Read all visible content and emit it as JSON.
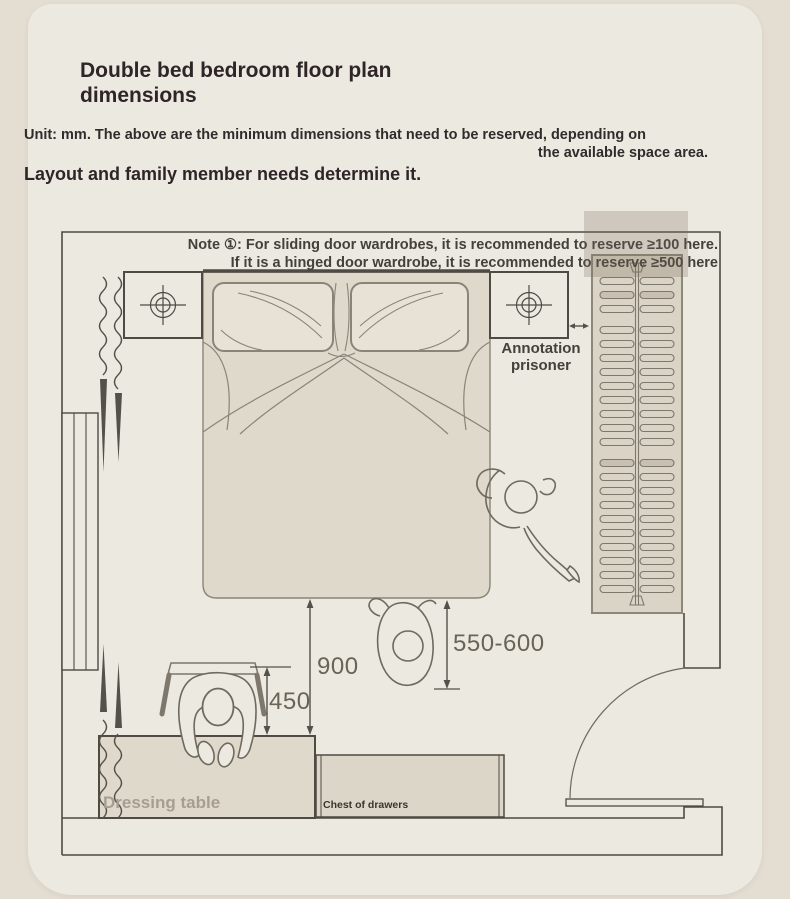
{
  "header": {
    "title": "Double bed bedroom floor plan dimensions",
    "unit_note_line1": "Unit: mm. The above are the minimum dimensions that need to be reserved, depending on",
    "unit_note_line2": "the available space area.",
    "layout_note": "Layout and family member needs determine it."
  },
  "plan": {
    "note": {
      "line1": "Note ①: For sliding door wardrobes, it is recommended to reserve ≥100 here.",
      "line2": "If it is a hinged door wardrobe, it is recommended to reserve ≥500 here"
    },
    "annotation": {
      "line1": "Annotation",
      "line2": "prisoner"
    },
    "dimensions": {
      "bed_foot_clearance": "900",
      "chair_pullout": "450",
      "wardrobe_clearance": "550-600"
    },
    "furniture": {
      "dressing_table": "Dressing table",
      "chest_of_drawers": "Chest of drawers"
    }
  },
  "colors": {
    "page_bg": "#e4ddd2",
    "card_bg": "#ece9e1",
    "wall_line": "#4f4a43",
    "sketch_line": "#7d776c",
    "furniture_fill": "#dcd6c8",
    "dimension_text": "#6b6356",
    "note_text": "#45403a",
    "title_text": "#2f2528",
    "muted_label": "#a69e91"
  }
}
